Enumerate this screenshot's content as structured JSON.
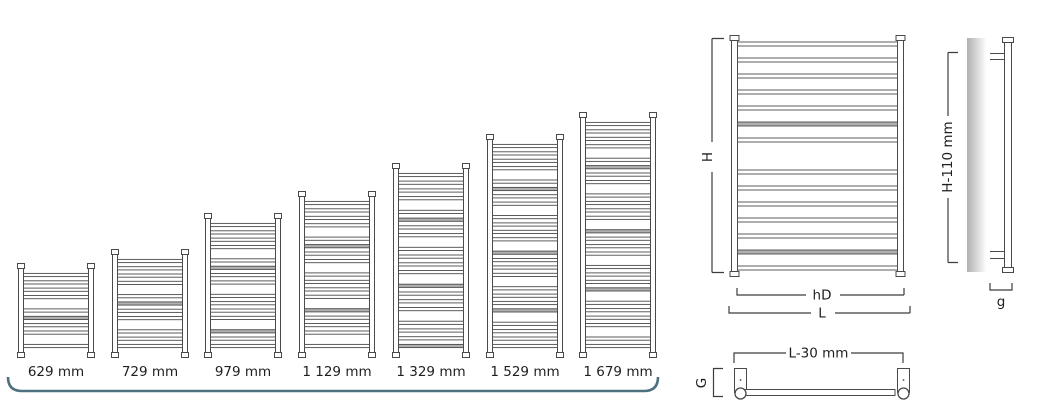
{
  "title": "Towel radiator size range and dimension diagram",
  "size_range": {
    "bracket_color": "#4e7180",
    "items": [
      {
        "label": "629 mm",
        "height_mm": 629
      },
      {
        "label": "729 mm",
        "height_mm": 729
      },
      {
        "label": "979 mm",
        "height_mm": 979
      },
      {
        "label": "1 129 mm",
        "height_mm": 1129
      },
      {
        "label": "1 329 mm",
        "height_mm": 1329
      },
      {
        "label": "1 529 mm",
        "height_mm": 1529
      },
      {
        "label": "1 679 mm",
        "height_mm": 1679
      }
    ]
  },
  "dimension_diagrams": {
    "front_view": {
      "height_label": "H",
      "hub_distance_label": "hD",
      "width_label": "L"
    },
    "side_view": {
      "height_label": "H-110 mm",
      "wall_gap_label": "g"
    },
    "bottom_view": {
      "connection_spacing_label": "L-30 mm",
      "depth_label": "G"
    }
  },
  "colors": {
    "drawing_line": "#4a4a4a",
    "dimension_line": "#3c3c3c",
    "rung_shade": "#b0b0b0",
    "wall_gradient_start": "#b0b0b0",
    "wall_gradient_end": "#ffffff",
    "text": "#1f1f1f"
  }
}
